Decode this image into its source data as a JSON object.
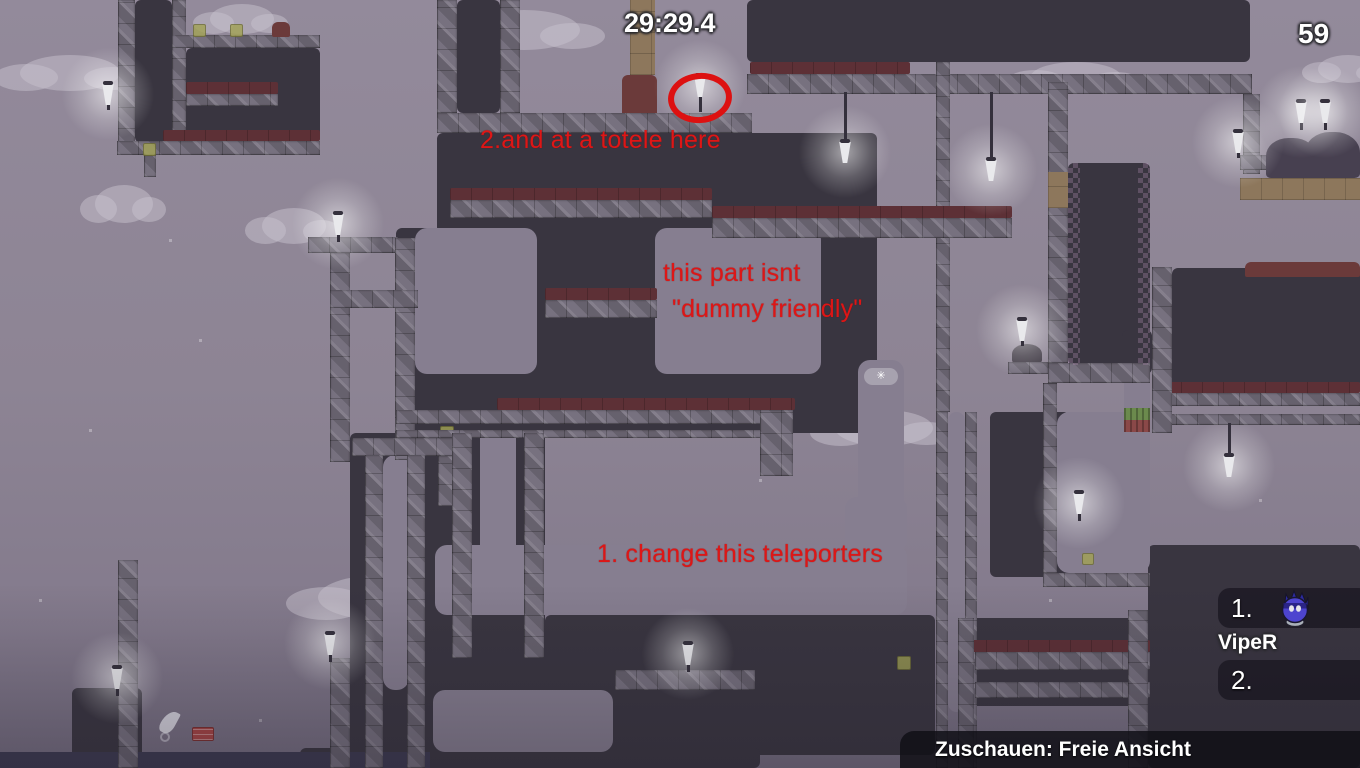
{
  "hud": {
    "timer": "29:29.4",
    "score": "59",
    "spectate_label": "Zuschauen: Freie Ansicht"
  },
  "annotations": {
    "note_top": "2.and at a totele here",
    "note_mid_line1": "this part isnt",
    "note_mid_line2": "\"dummy friendly\"",
    "note_bottom": "1. change this teleporters",
    "color": "#de1616"
  },
  "scoreboard": {
    "entries": [
      {
        "rank": "1.",
        "name": "VipeR"
      },
      {
        "rank": "2.",
        "name": ""
      }
    ]
  },
  "colors": {
    "sky": "#8d8494",
    "dark_tiles": "#393540",
    "beam": "#77717f",
    "freeze_red": "#5d3036",
    "dirt_tan": "#8d775c",
    "annotation_red": "#de1616",
    "lamp_glow": "#ffffff",
    "tee_body": "#4d44cf",
    "hud_text": "#ffffff"
  }
}
